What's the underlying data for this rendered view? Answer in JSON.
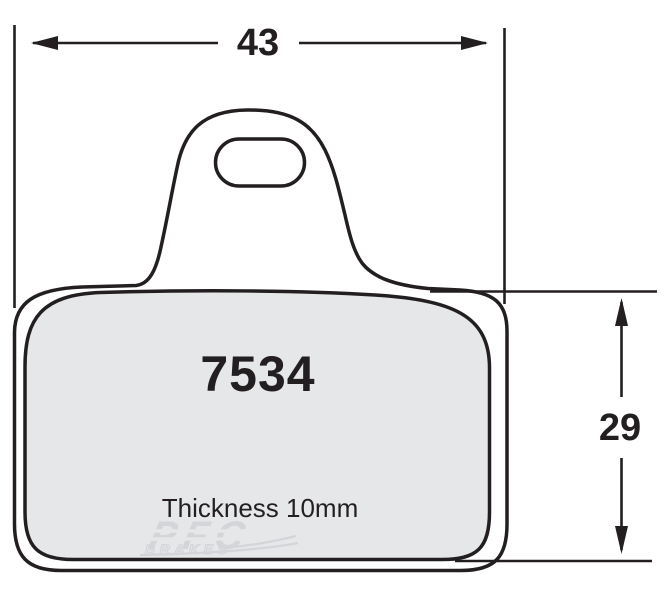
{
  "drawing": {
    "part_number": "7534",
    "thickness_label": "Thickness 10mm",
    "dimensions": {
      "width": "43",
      "height": "29"
    }
  },
  "watermark": {
    "brand": "PFC",
    "sub_brand": "BRAKES"
  },
  "colors": {
    "line": "#231f20",
    "pad_fill": "#e6e7e9",
    "watermark": "#d4d5d9",
    "background": "#ffffff"
  }
}
